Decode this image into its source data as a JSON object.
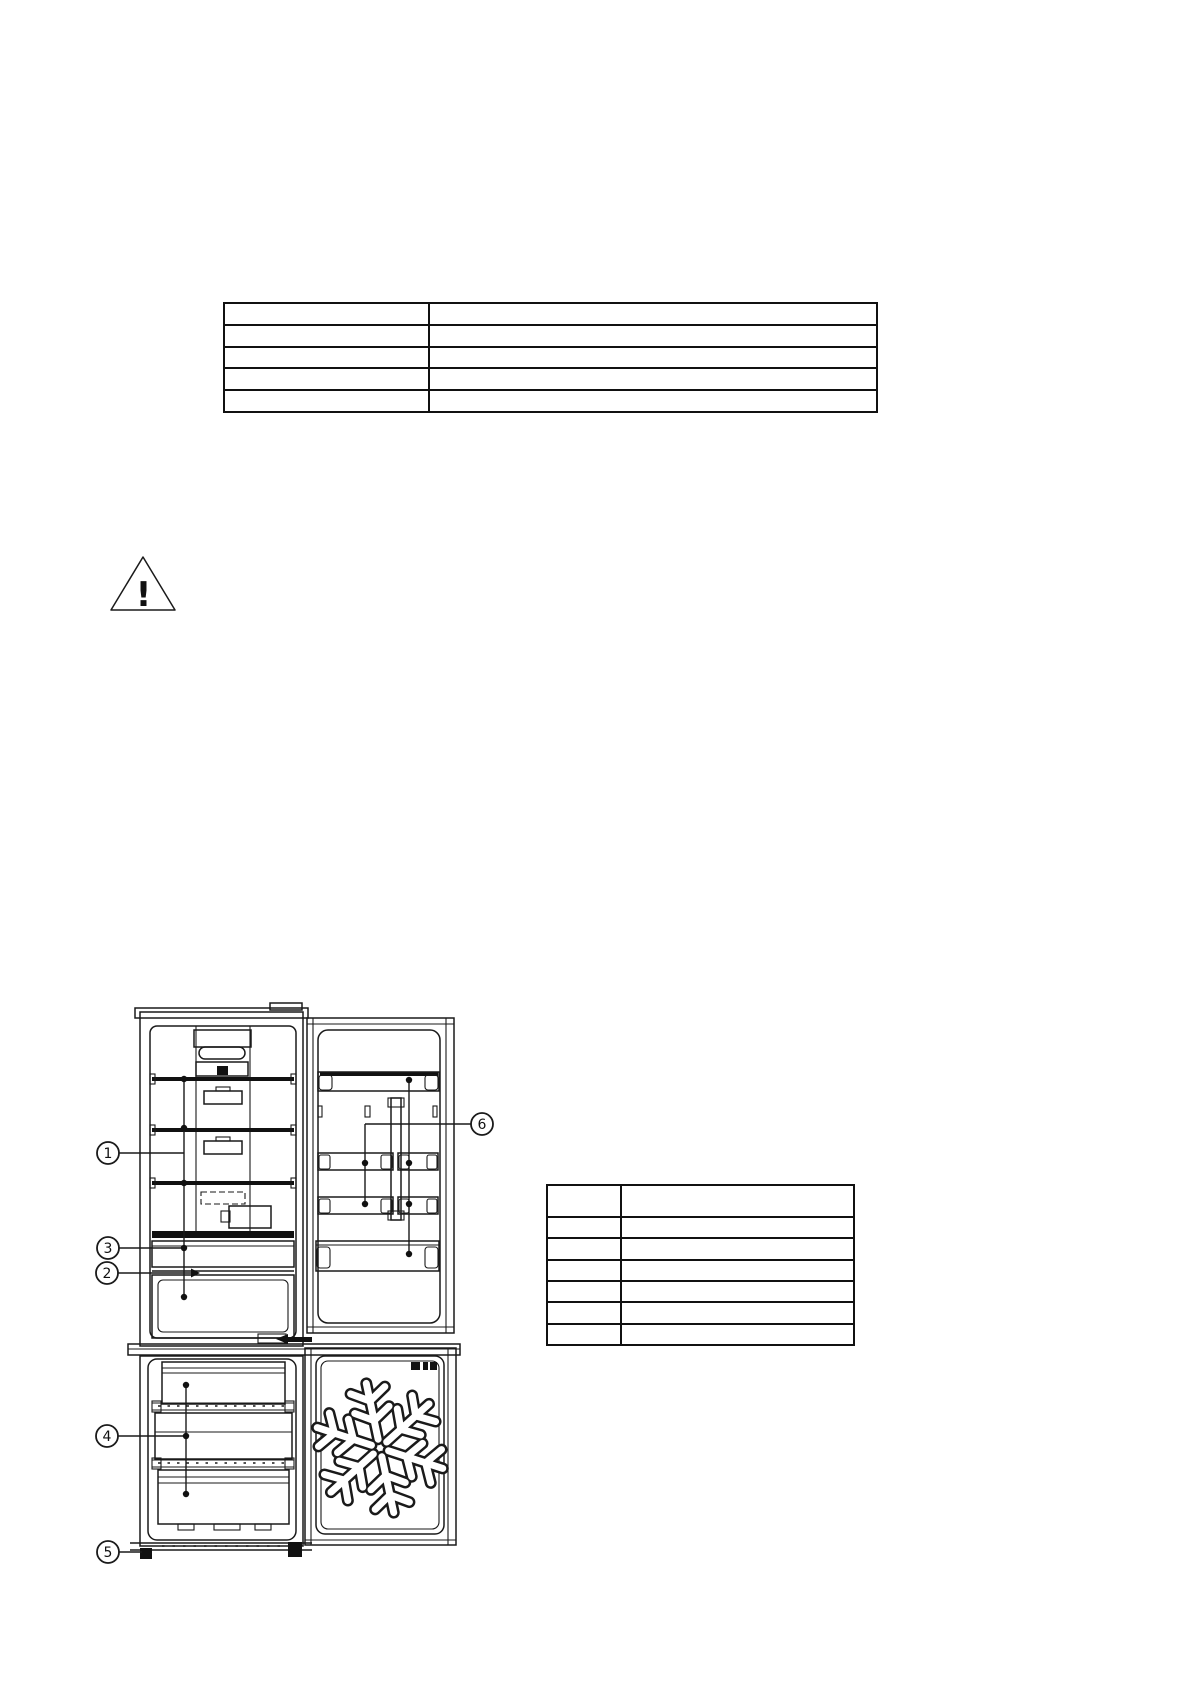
{
  "document": {
    "background": "#ffffff",
    "ink": "#111111"
  },
  "top_table": {
    "rows": 5,
    "columns": 2,
    "cells": [
      [
        "",
        ""
      ],
      [
        "",
        ""
      ],
      [
        "",
        ""
      ],
      [
        "",
        ""
      ],
      [
        "",
        ""
      ]
    ]
  },
  "warning": {
    "icon": "warning-triangle-icon",
    "symbol": "!"
  },
  "diagram": {
    "name": "refrigerator-interior-diagram",
    "callouts": [
      {
        "label": "1"
      },
      {
        "label": "2"
      },
      {
        "label": "3"
      },
      {
        "label": "4"
      },
      {
        "label": "5"
      },
      {
        "label": "6"
      }
    ],
    "icons": [
      "snowflake-icon",
      "freezer-door-label"
    ]
  },
  "right_table": {
    "rows": 7,
    "columns": 2,
    "cells": [
      [
        "",
        ""
      ],
      [
        "",
        ""
      ],
      [
        "",
        ""
      ],
      [
        "",
        ""
      ],
      [
        "",
        ""
      ],
      [
        "",
        ""
      ],
      [
        "",
        ""
      ]
    ]
  }
}
